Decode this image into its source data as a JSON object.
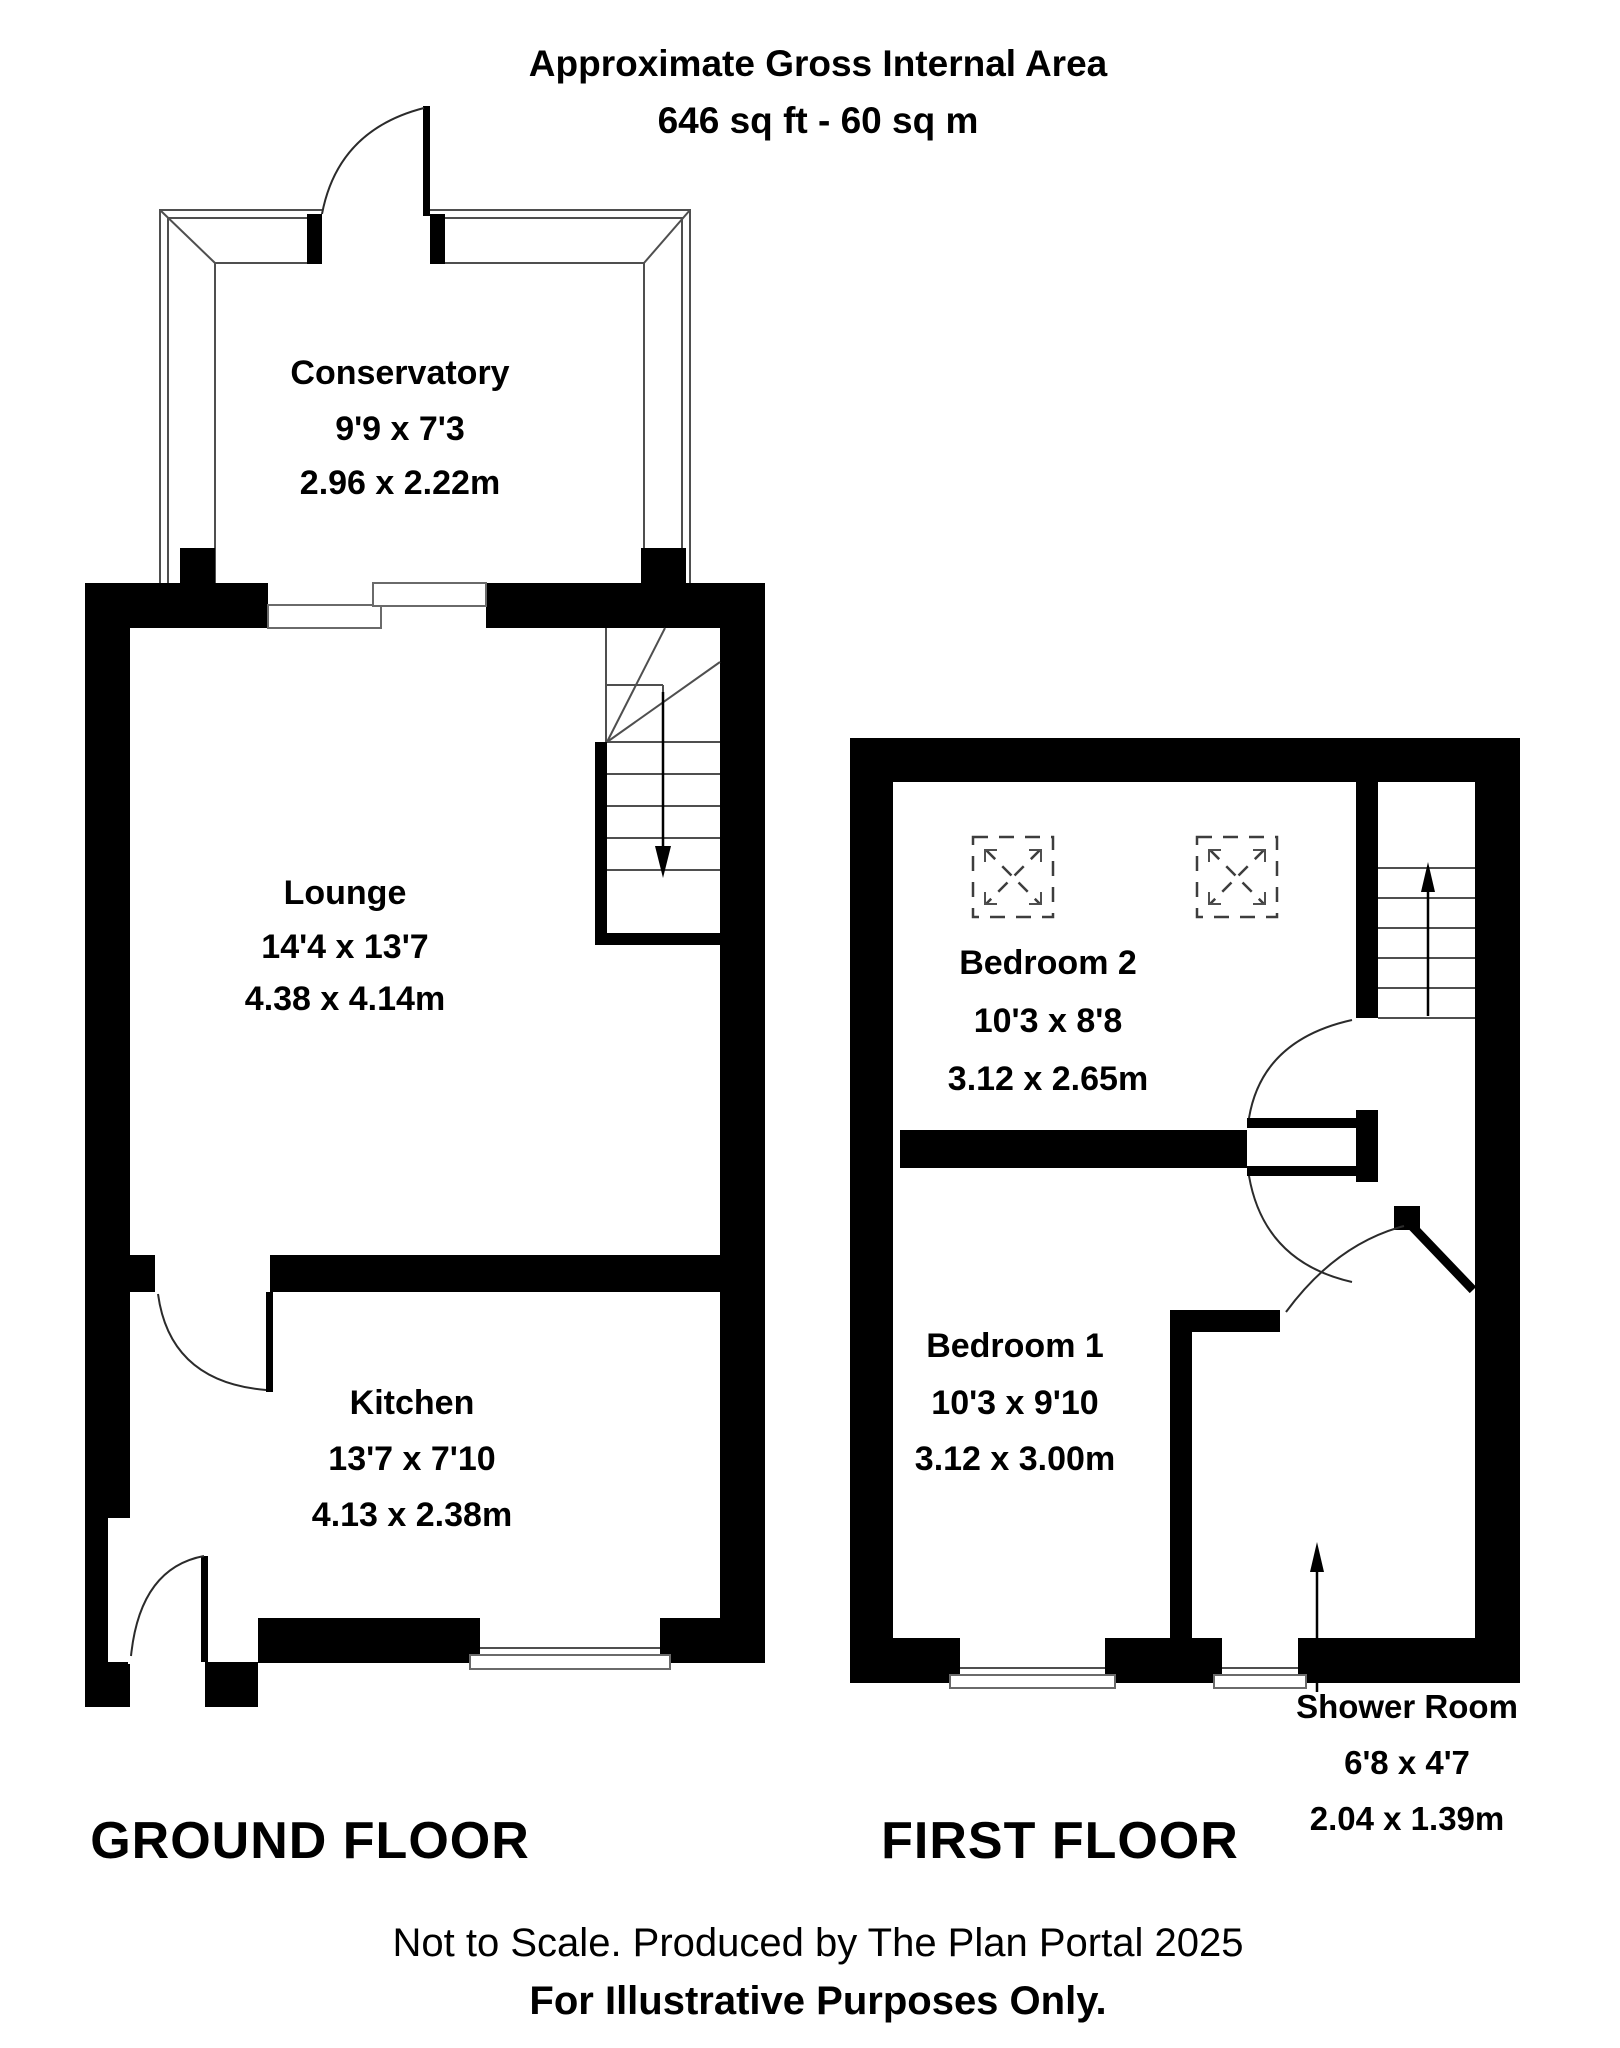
{
  "title": {
    "line1": "Approximate Gross Internal Area",
    "line2": "646 sq ft - 60 sq m"
  },
  "ground_floor": {
    "label": "GROUND FLOOR",
    "rooms": [
      {
        "name": "Conservatory",
        "imperial": "9'9 x 7'3",
        "metric": "2.96 x 2.22m"
      },
      {
        "name": "Lounge",
        "imperial": "14'4 x 13'7",
        "metric": "4.38 x 4.14m"
      },
      {
        "name": "Kitchen",
        "imperial": "13'7  x 7'10",
        "metric": "4.13 x 2.38m"
      }
    ]
  },
  "first_floor": {
    "label": "FIRST FLOOR",
    "rooms": [
      {
        "name": "Bedroom 2",
        "imperial": "10'3 x 8'8",
        "metric": "3.12 x 2.65m"
      },
      {
        "name": "Bedroom 1",
        "imperial": "10'3 x 9'10",
        "metric": "3.12 x 3.00m"
      },
      {
        "name": "Shower Room",
        "imperial": "6'8 x 4'7",
        "metric": "2.04 x 1.39m"
      }
    ]
  },
  "footer": {
    "line1": "Not to Scale. Produced by The Plan Portal 2025",
    "line2": "For Illustrative Purposes Only."
  },
  "colors": {
    "wall": "#000000",
    "background": "#ffffff",
    "construction_line": "#4f4f4f"
  }
}
